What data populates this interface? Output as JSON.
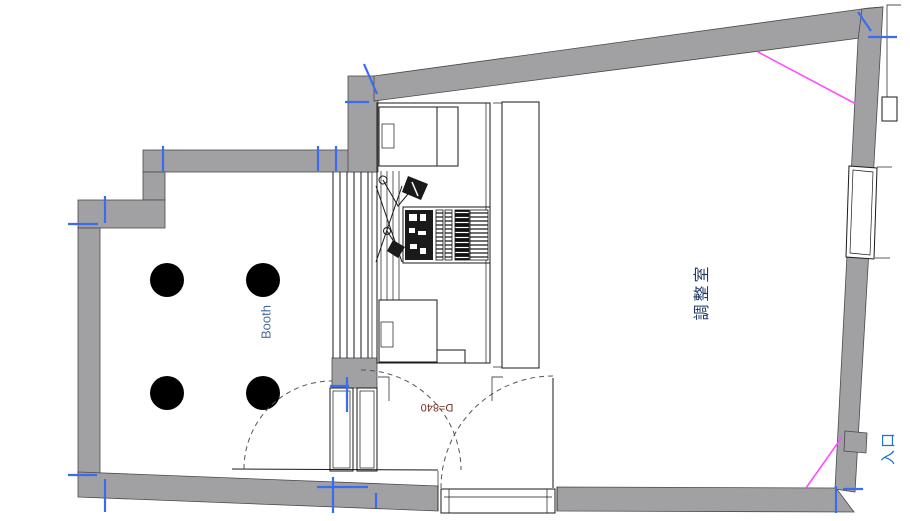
{
  "title": "Studio floor plan",
  "labels": {
    "booth": "Booth",
    "control_room": "調整室",
    "entrance": "入口",
    "door_dimension": "D=840"
  },
  "rooms": {
    "booth": {
      "label": "Booth",
      "speaker_dot_count": 4
    },
    "control_room": {
      "label": "調整室"
    },
    "entrance": {
      "label": "入口",
      "door_dimension": "D=840"
    }
  },
  "colors": {
    "background": "#ffffff",
    "wall_fill": "#a1a1a3",
    "wall_edge": "#4a4a4a",
    "linework": "#1a1a1a",
    "door_arc": "#555555",
    "tick_blue": "#3b6cf0",
    "magenta": "#ff4dff",
    "speaker_dot": "#000000",
    "booth_text": "#49689c",
    "control_room_text": "#1f3864",
    "entrance_text": "#1d74d4",
    "dimension_text": "#703020"
  }
}
